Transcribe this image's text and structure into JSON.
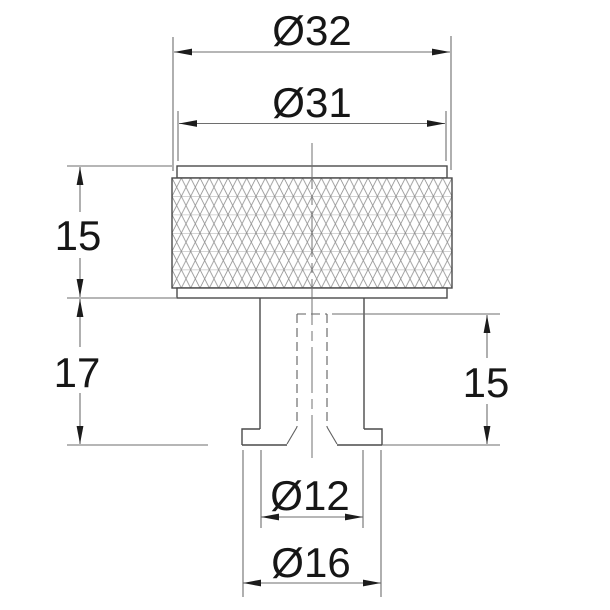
{
  "meta": {
    "title": "Knurled knob technical drawing",
    "view": "front view with hidden hole"
  },
  "labels": {
    "dia_outer": "Ø32",
    "dia_body": "Ø31",
    "head_height": "15",
    "stem_length": "17",
    "hole_depth": "15",
    "dia_stem": "Ø12",
    "dia_base": "Ø16"
  },
  "colors": {
    "background": "#ffffff",
    "part_line": "#4a4a4a",
    "dimension_line": "#6e6e6e",
    "hidden_line": "#5f5f5f",
    "text": "#161616"
  }
}
